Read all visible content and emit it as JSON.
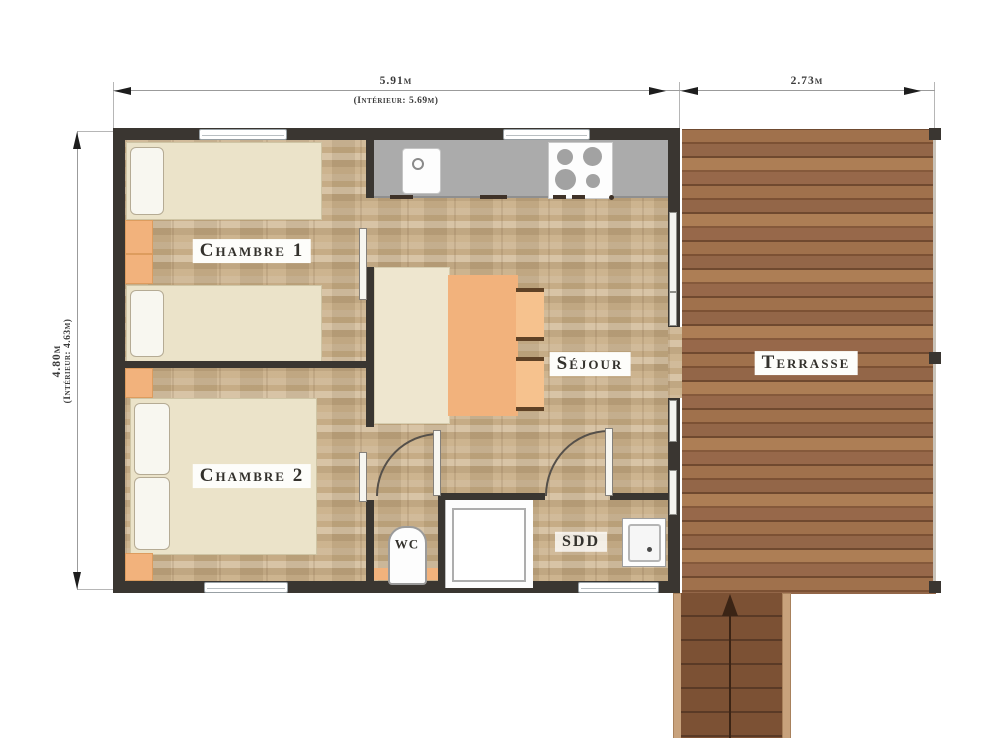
{
  "page": {
    "type": "architectural floor plan",
    "background": "#ffffff"
  },
  "dimensions": {
    "top_width": {
      "value": "5.91m",
      "interior": "(Intérieur: 5.69m)"
    },
    "terrace_width": {
      "value": "2.73m"
    },
    "left_height": {
      "value": "4.80m",
      "interior": "(Intérieur: 4.63m)"
    }
  },
  "rooms": {
    "chambre1": {
      "label": "Chambre 1"
    },
    "chambre2": {
      "label": "Chambre 2"
    },
    "sejour": {
      "label": "Séjour"
    },
    "wc": {
      "label": "WC"
    },
    "sdd": {
      "label": "SDD"
    },
    "terrasse": {
      "label": "Terrasse"
    }
  },
  "fixtures": {
    "kitchen": [
      "counter",
      "sink",
      "stove-4-burners"
    ],
    "chambre1": [
      "single-bed",
      "single-bed",
      "nightstand",
      "nightstand"
    ],
    "chambre2": [
      "double-bed",
      "nightstand",
      "nightstand"
    ],
    "sejour": [
      "bench",
      "dining-table",
      "chair",
      "chair"
    ],
    "wc": [
      "toilet",
      "shelf"
    ],
    "sdd": [
      "shower",
      "washbasin"
    ],
    "exterior": [
      "terrace-deck",
      "railing",
      "stairs",
      "direction-arrow"
    ]
  },
  "colors": {
    "wall": "#3a3631",
    "floor_wood": "#c8ae8a",
    "terrace_wood": "#96684a",
    "accent_orange": "#f2b27c",
    "bed_cream": "#ebe3c9",
    "counter_gray": "#ababab",
    "label_text": "#33312c"
  }
}
